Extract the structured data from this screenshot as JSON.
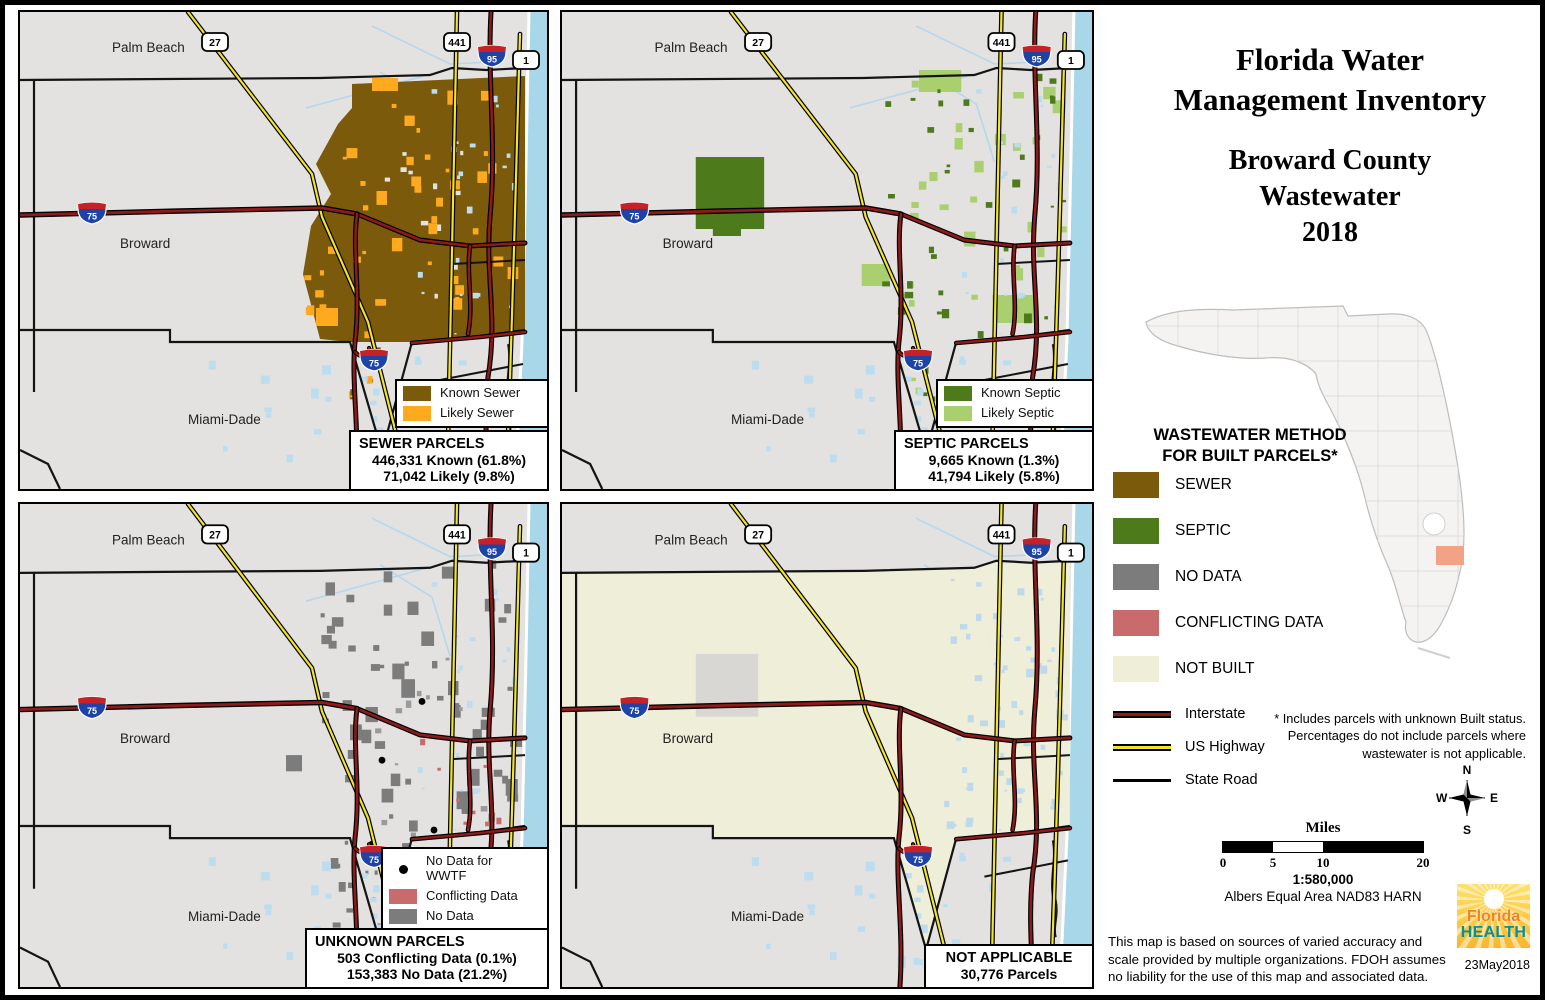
{
  "figure": {
    "title_lines": [
      "Florida Water",
      "Management Inventory"
    ],
    "subtitle_lines": [
      "Broward County",
      "Wastewater",
      "2018"
    ],
    "date": "23May2018"
  },
  "map_labels": {
    "palm_beach": "Palm Beach",
    "broward": "Broward",
    "miami_dade": "Miami-Dade"
  },
  "shields": {
    "us27": "27",
    "us441": "441",
    "i95": "95",
    "us1": "1",
    "i75": "75"
  },
  "panels": {
    "sewer": {
      "legend": [
        {
          "label": "Known Sewer",
          "color": "#7B5A0C"
        },
        {
          "label": "Likely Sewer",
          "color": "#FFAA1E"
        }
      ],
      "stats": {
        "title": "SEWER PARCELS",
        "lines": [
          "446,331 Known (61.8%)",
          "71,042 Likely (9.8%)"
        ]
      }
    },
    "septic": {
      "legend": [
        {
          "label": "Known Septic",
          "color": "#4D7A1A"
        },
        {
          "label": "Likely Septic",
          "color": "#A9CF6F"
        }
      ],
      "stats": {
        "title": "SEPTIC PARCELS",
        "lines": [
          "9,665 Known (1.3%)",
          "41,794 Likely (5.8%)"
        ]
      }
    },
    "unknown": {
      "legend": [
        {
          "label": "No Data for WWTF",
          "color": "#000000"
        },
        {
          "label": "Conflicting Data",
          "color": "#C96A6C"
        },
        {
          "label": "No Data",
          "color": "#7C7C7C"
        }
      ],
      "stats": {
        "title": "UNKNOWN PARCELS",
        "lines": [
          "503 Conflicting Data (0.1%)",
          "153,383 No Data (21.2%)"
        ]
      }
    },
    "not_applicable": {
      "stats": {
        "title": "NOT APPLICABLE",
        "lines": [
          "30,776 Parcels"
        ]
      }
    }
  },
  "sidebar": {
    "legend_title_lines": [
      "WASTEWATER METHOD",
      "FOR BUILT PARCELS*"
    ],
    "legend": [
      {
        "label": "SEWER",
        "color": "#7B5A0C"
      },
      {
        "label": "SEPTIC",
        "color": "#4D7A1A"
      },
      {
        "label": "NO DATA",
        "color": "#7C7C7C"
      },
      {
        "label": "CONFLICTING DATA",
        "color": "#C96A6C"
      },
      {
        "label": "NOT BUILT",
        "color": "#EFEED7"
      }
    ],
    "road_legend": [
      {
        "label": "Interstate",
        "type": "interstate"
      },
      {
        "label": "US Highway",
        "type": "us-highway"
      },
      {
        "label": "State Road",
        "type": "state-road"
      }
    ],
    "footnote": "* Includes parcels with unknown Built status. Percentages do not include parcels where wastewater is not applicable.",
    "compass": {
      "n": "N",
      "e": "E",
      "s": "S",
      "w": "W"
    },
    "scale_bar": {
      "title": "Miles",
      "ticks": [
        "0",
        "5",
        "10",
        "20"
      ],
      "ratio": "1:580,000",
      "projection": "Albers Equal Area NAD83 HARN"
    },
    "disclaimer": "This map is based on sources of varied accuracy and scale provided by multiple organizations. FDOH assumes no liability for the use of this map and associated data.",
    "logo": {
      "line1": "Florida",
      "line2": "HEALTH"
    },
    "inset": {
      "highlight_color": "#F2A285"
    }
  }
}
